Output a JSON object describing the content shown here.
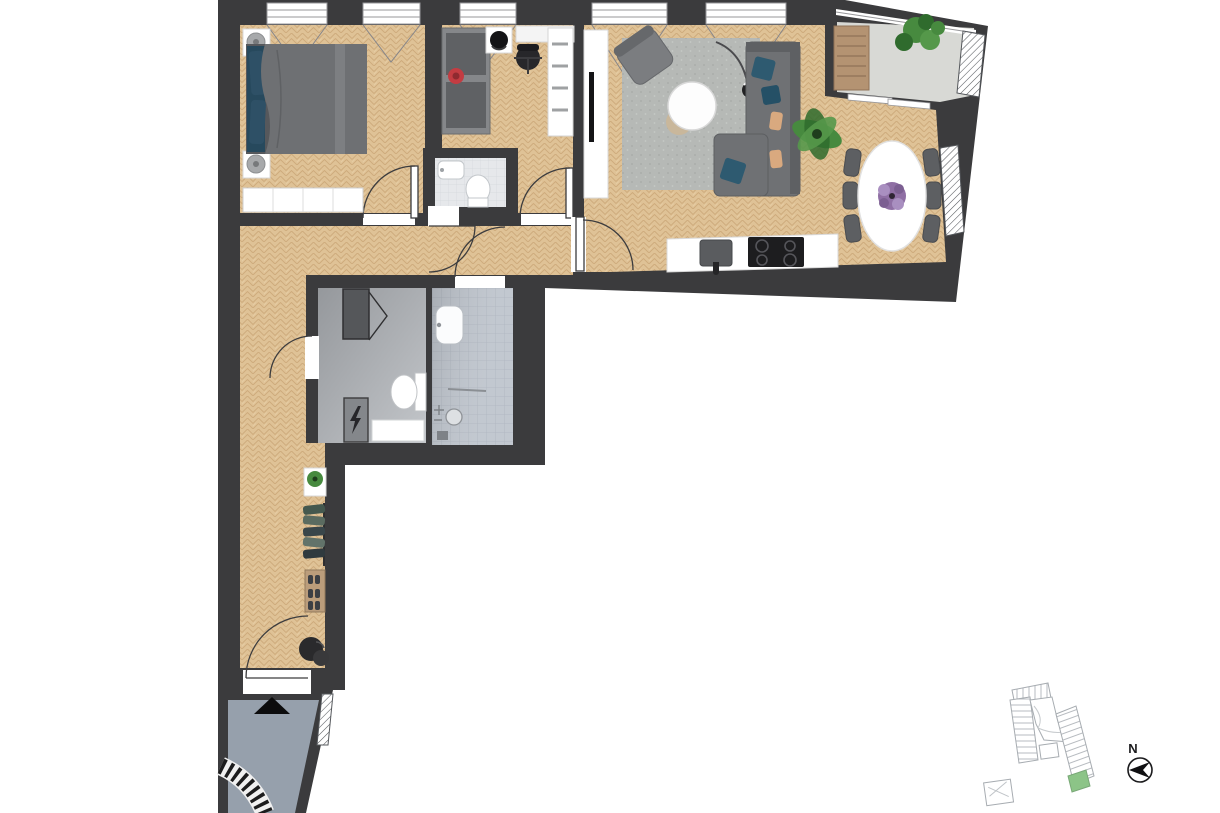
{
  "compass": {
    "label": "N"
  },
  "colors": {
    "wall": "#3b3b3d",
    "wood_base": "#dfc296",
    "wood_line": "#c39d6e",
    "concrete": "#d8d9d5",
    "porch_floor": "#96a0ac",
    "tile_base": "#c2c8d0",
    "tile_line": "#aeb5bf",
    "tile_light_base": "#e6e8eb",
    "tile_light_line": "#d4d8dc",
    "laundry_dark": "#95989c",
    "laundry_light": "#c3c6ca",
    "rug": "#b6b9b6",
    "sofa": "#6f7174",
    "sofa_dark": "#5e6063",
    "cushion_teal": "#2e5a70",
    "bed_duvet": "#6e7073",
    "headboard_navy": "#27495d",
    "chair_dark": "#5d5f62",
    "white": "#ffffff",
    "wood_furniture": "#b49372",
    "plant": "#478a3f",
    "plant_dark": "#2f6b2d",
    "flower_purple": "#8f6fa4",
    "toy_red": "#c33c42",
    "black": "#1b1b1d",
    "outline": "#3c3c3e",
    "map_line": "#a7acb1",
    "map_green": "#8cc487",
    "lamp_gray": "#a7a9ab",
    "tan": "#d9a97f"
  },
  "legend": {
    "plan_type": "furnished apartment floor plan, L-shaped, herringbone parquet",
    "rooms": [
      "bedroom",
      "kids-room-office",
      "guest-wc",
      "living-dining-room",
      "kitchen",
      "balcony",
      "shower-bathroom",
      "laundry-utility-wc",
      "hallway",
      "entrance-porch"
    ],
    "furniture": {
      "bedroom": [
        "double-bed",
        "teal-pillows",
        "nightstand-with-lamp-top",
        "nightstand-with-lamp-bottom",
        "wardrobe"
      ],
      "kids_room": [
        "daybed",
        "red-toy",
        "desk",
        "office-chair",
        "side-table-with-hat",
        "shelf-unit"
      ],
      "guest_wc": [
        "washbasin",
        "toilet"
      ],
      "living_room": [
        "tv-sideboard",
        "tv",
        "armchair",
        "area-rug",
        "round-coffee-table",
        "floor-lamp",
        "corner-sofa",
        "potted-plant"
      ],
      "dining": [
        "oval-table",
        "six-chairs",
        "purple-bouquet"
      ],
      "kitchen": [
        "counter",
        "sink-with-faucet",
        "cooktop-4-burners"
      ],
      "balcony": [
        "wooden-lounger",
        "plant"
      ],
      "bathroom": [
        "washbasin",
        "towel-bar",
        "shower-head",
        "shower-drain"
      ],
      "laundry": [
        "washing-machine-open-door",
        "toilet",
        "electrical-panel-lightning",
        "cabinet"
      ],
      "hallway": [
        "plant-table",
        "coat-rack-with-clothes",
        "shoe-console",
        "pouf-and-bag"
      ],
      "entrance": [
        "entrance-arrow",
        "curved-stair"
      ]
    },
    "annotations": [
      "north-compass",
      "site-key-plan-with-highlighted-unit"
    ]
  }
}
